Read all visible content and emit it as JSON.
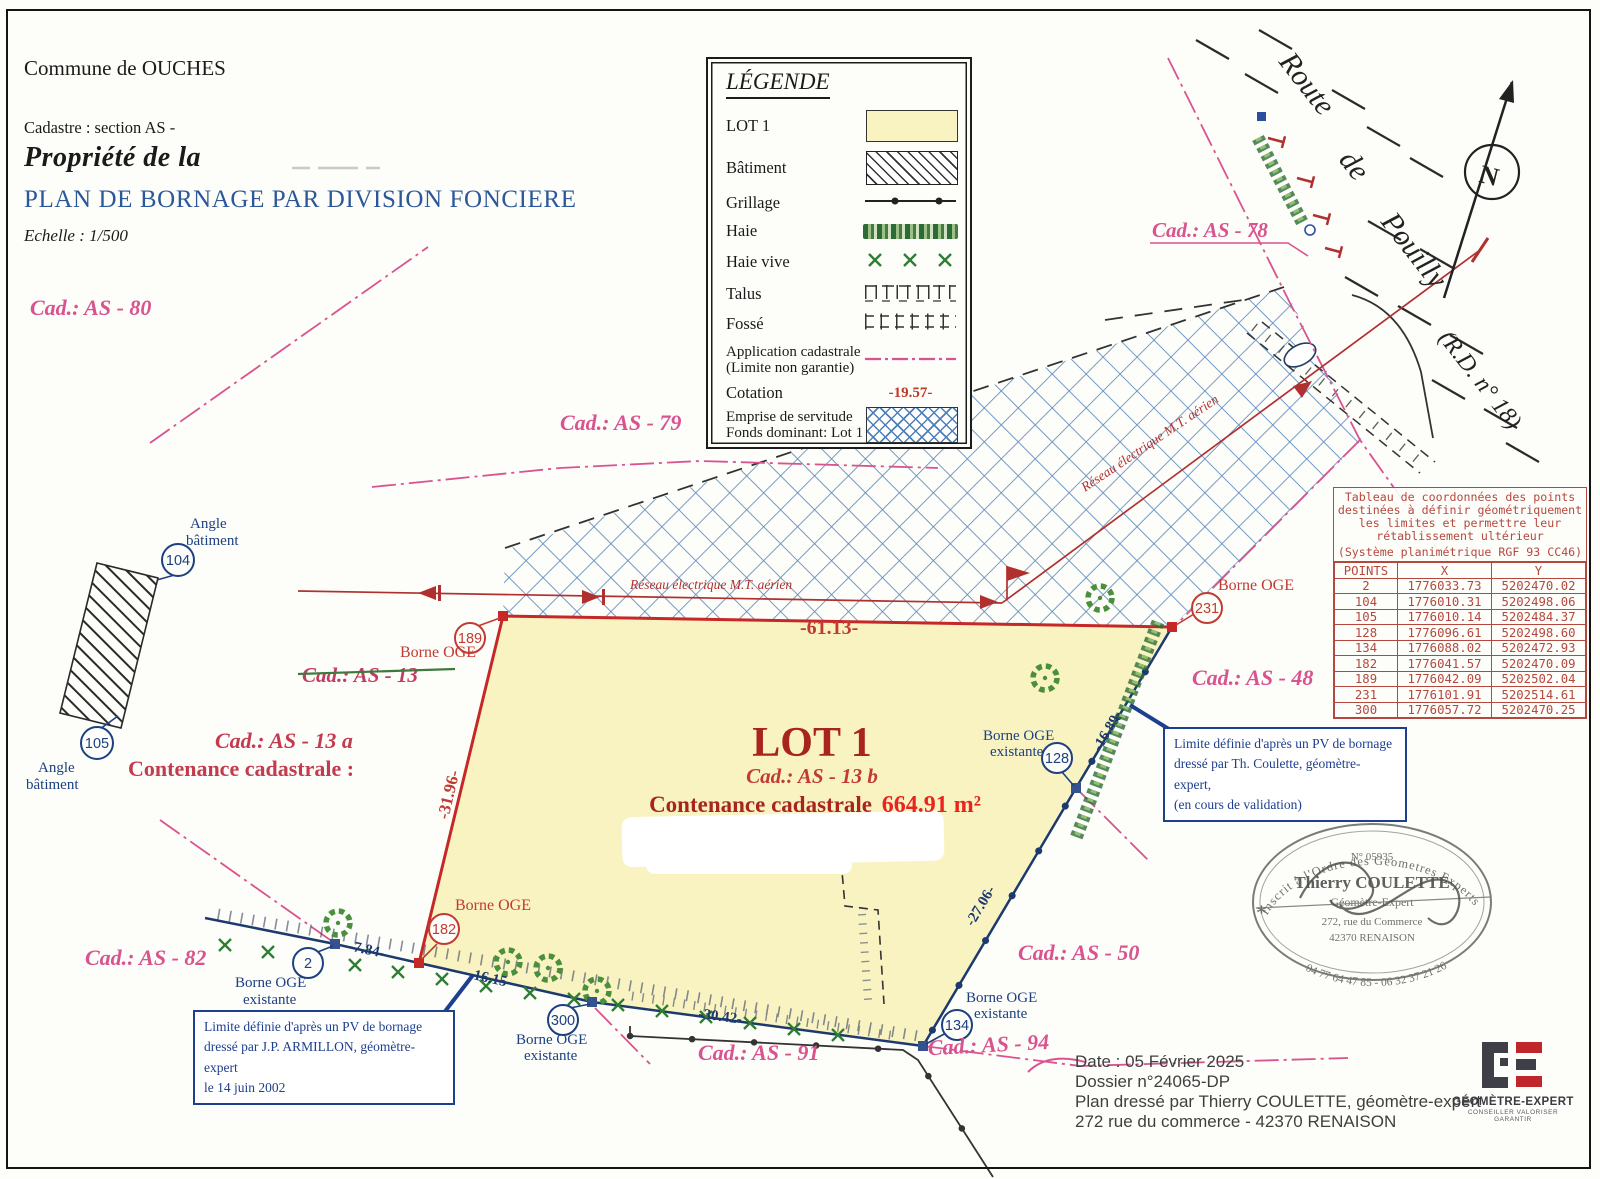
{
  "title_block": {
    "commune": "Commune de OUCHES",
    "cadastre": "Cadastre : section AS -",
    "propriete": "Propriété de la",
    "main_title": "PLAN DE BORNAGE PAR DIVISION FONCIERE",
    "echelle": "Echelle : 1/500"
  },
  "legend": {
    "title": "LÉGENDE",
    "items": {
      "lot": "LOT 1",
      "batiment": "Bâtiment",
      "grillage": "Grillage",
      "haie": "Haie",
      "haie_vive": "Haie vive",
      "talus": "Talus",
      "fosse": "Fossé",
      "application_1": "Application cadastrale",
      "application_2": "(Limite non garantie)",
      "cotation": "Cotation",
      "emprise_1": "Emprise de servitude",
      "emprise_2": "Fonds dominant: Lot 1"
    },
    "cotation_sample": "-19.57-"
  },
  "coord_table": {
    "title_lines": [
      "Tableau de coordonnées des points",
      "destinées à définir géométriquement",
      "les limites et permettre leur",
      "rétablissement ultérieur"
    ],
    "subtitle": "(Système planimétrique RGF 93 CC46)",
    "columns": {
      "points": "POINTS",
      "x": "X",
      "y": "Y"
    },
    "rows": [
      {
        "p": "2",
        "x": "1776033.73",
        "y": "5202470.02"
      },
      {
        "p": "104",
        "x": "1776010.31",
        "y": "5202498.06"
      },
      {
        "p": "105",
        "x": "1776010.14",
        "y": "5202484.37"
      },
      {
        "p": "128",
        "x": "1776096.61",
        "y": "5202498.60"
      },
      {
        "p": "134",
        "x": "1776088.02",
        "y": "5202472.93"
      },
      {
        "p": "182",
        "x": "1776041.57",
        "y": "5202470.09"
      },
      {
        "p": "189",
        "x": "1776042.09",
        "y": "5202502.04"
      },
      {
        "p": "231",
        "x": "1776101.91",
        "y": "5202514.61"
      },
      {
        "p": "300",
        "x": "1776057.72",
        "y": "5202470.25"
      }
    ]
  },
  "lot": {
    "name": "LOT 1",
    "cad": "Cad.: AS - 13 b",
    "contenance_label": "Contenance cadastrale",
    "area": "664.91 m²"
  },
  "parcel_labels": {
    "as_80": "Cad.: AS - 80",
    "as_79": "Cad.: AS - 79",
    "as_78": "Cad.: AS - 78",
    "as_13": "Cad.: AS - 13",
    "as_13a": "Cad.: AS - 13 a",
    "contenance_13a": "Contenance cadastrale :",
    "as_48": "Cad.: AS - 48",
    "as_50": "Cad.: AS - 50",
    "as_82": "Cad.: AS - 82",
    "as_91": "Cad.: AS - 91",
    "as_94": "Cad.: AS - 94"
  },
  "road": {
    "word1": "Route",
    "word2": "de",
    "word3": "Pouilly",
    "rd": "(R.D. n° 18)"
  },
  "north": "N",
  "power_line_label": "Réseau électrique M.T. aérien",
  "measurements": {
    "top": "-61.13-",
    "left": "-31.96-",
    "b1": "-7.84-",
    "b2": "-16.15-",
    "b3": "-30.42-",
    "right_low": "-27.06-",
    "right_up": "-16.89-"
  },
  "points": {
    "p2": {
      "num": "2",
      "l1": "Borne OGE",
      "l2": "existante"
    },
    "p104": {
      "num": "104",
      "l1": "Angle",
      "l2": "bâtiment"
    },
    "p105": {
      "num": "105",
      "l1": "Angle",
      "l2": "bâtiment"
    },
    "p128": {
      "num": "128",
      "l1": "Borne OGE",
      "l2": "existante"
    },
    "p134": {
      "num": "134",
      "l1": "Borne OGE",
      "l2": "existante"
    },
    "p182": {
      "num": "182",
      "l1": "Borne OGE"
    },
    "p189": {
      "num": "189",
      "l1": "Borne OGE"
    },
    "p231": {
      "num": "231",
      "l1": "Borne OGE"
    },
    "p300": {
      "num": "300",
      "l1": "Borne OGE",
      "l2": "existante"
    }
  },
  "notes": {
    "coulette": [
      "Limite définie d'après un PV de bornage",
      "dressé par Th. Coulette, géomètre-expert,",
      "(en cours de validation)"
    ],
    "armillon": [
      "Limite définie d'après un PV de bornage",
      "dressé par J.P. ARMILLON, géomètre-expert",
      "le 14 juin 2002"
    ]
  },
  "stamp": {
    "arc_top": "Inscrit à l'Ordre des Geometres Experts",
    "number": "N° 05935",
    "name": "Thierry COULETTE",
    "role": "Géomètre-Expert",
    "addr1": "272, rue du Commerce",
    "addr2": "42370 RENAISON",
    "phone": "04 77 64 47 85 - 06 32 37 21 26"
  },
  "footer": {
    "date": "Date : 05 Février 2025",
    "dossier": "Dossier n°24065-DP",
    "line3": "Plan dressé par Thierry COULETTE, géomètre-expert",
    "line4": "272 rue du commerce - 42370 RENAISON"
  },
  "logo": {
    "name": "GÉOMÈTRE-EXPERT",
    "tagline": "CONSEILLER VALORISER GARANTIR"
  }
}
